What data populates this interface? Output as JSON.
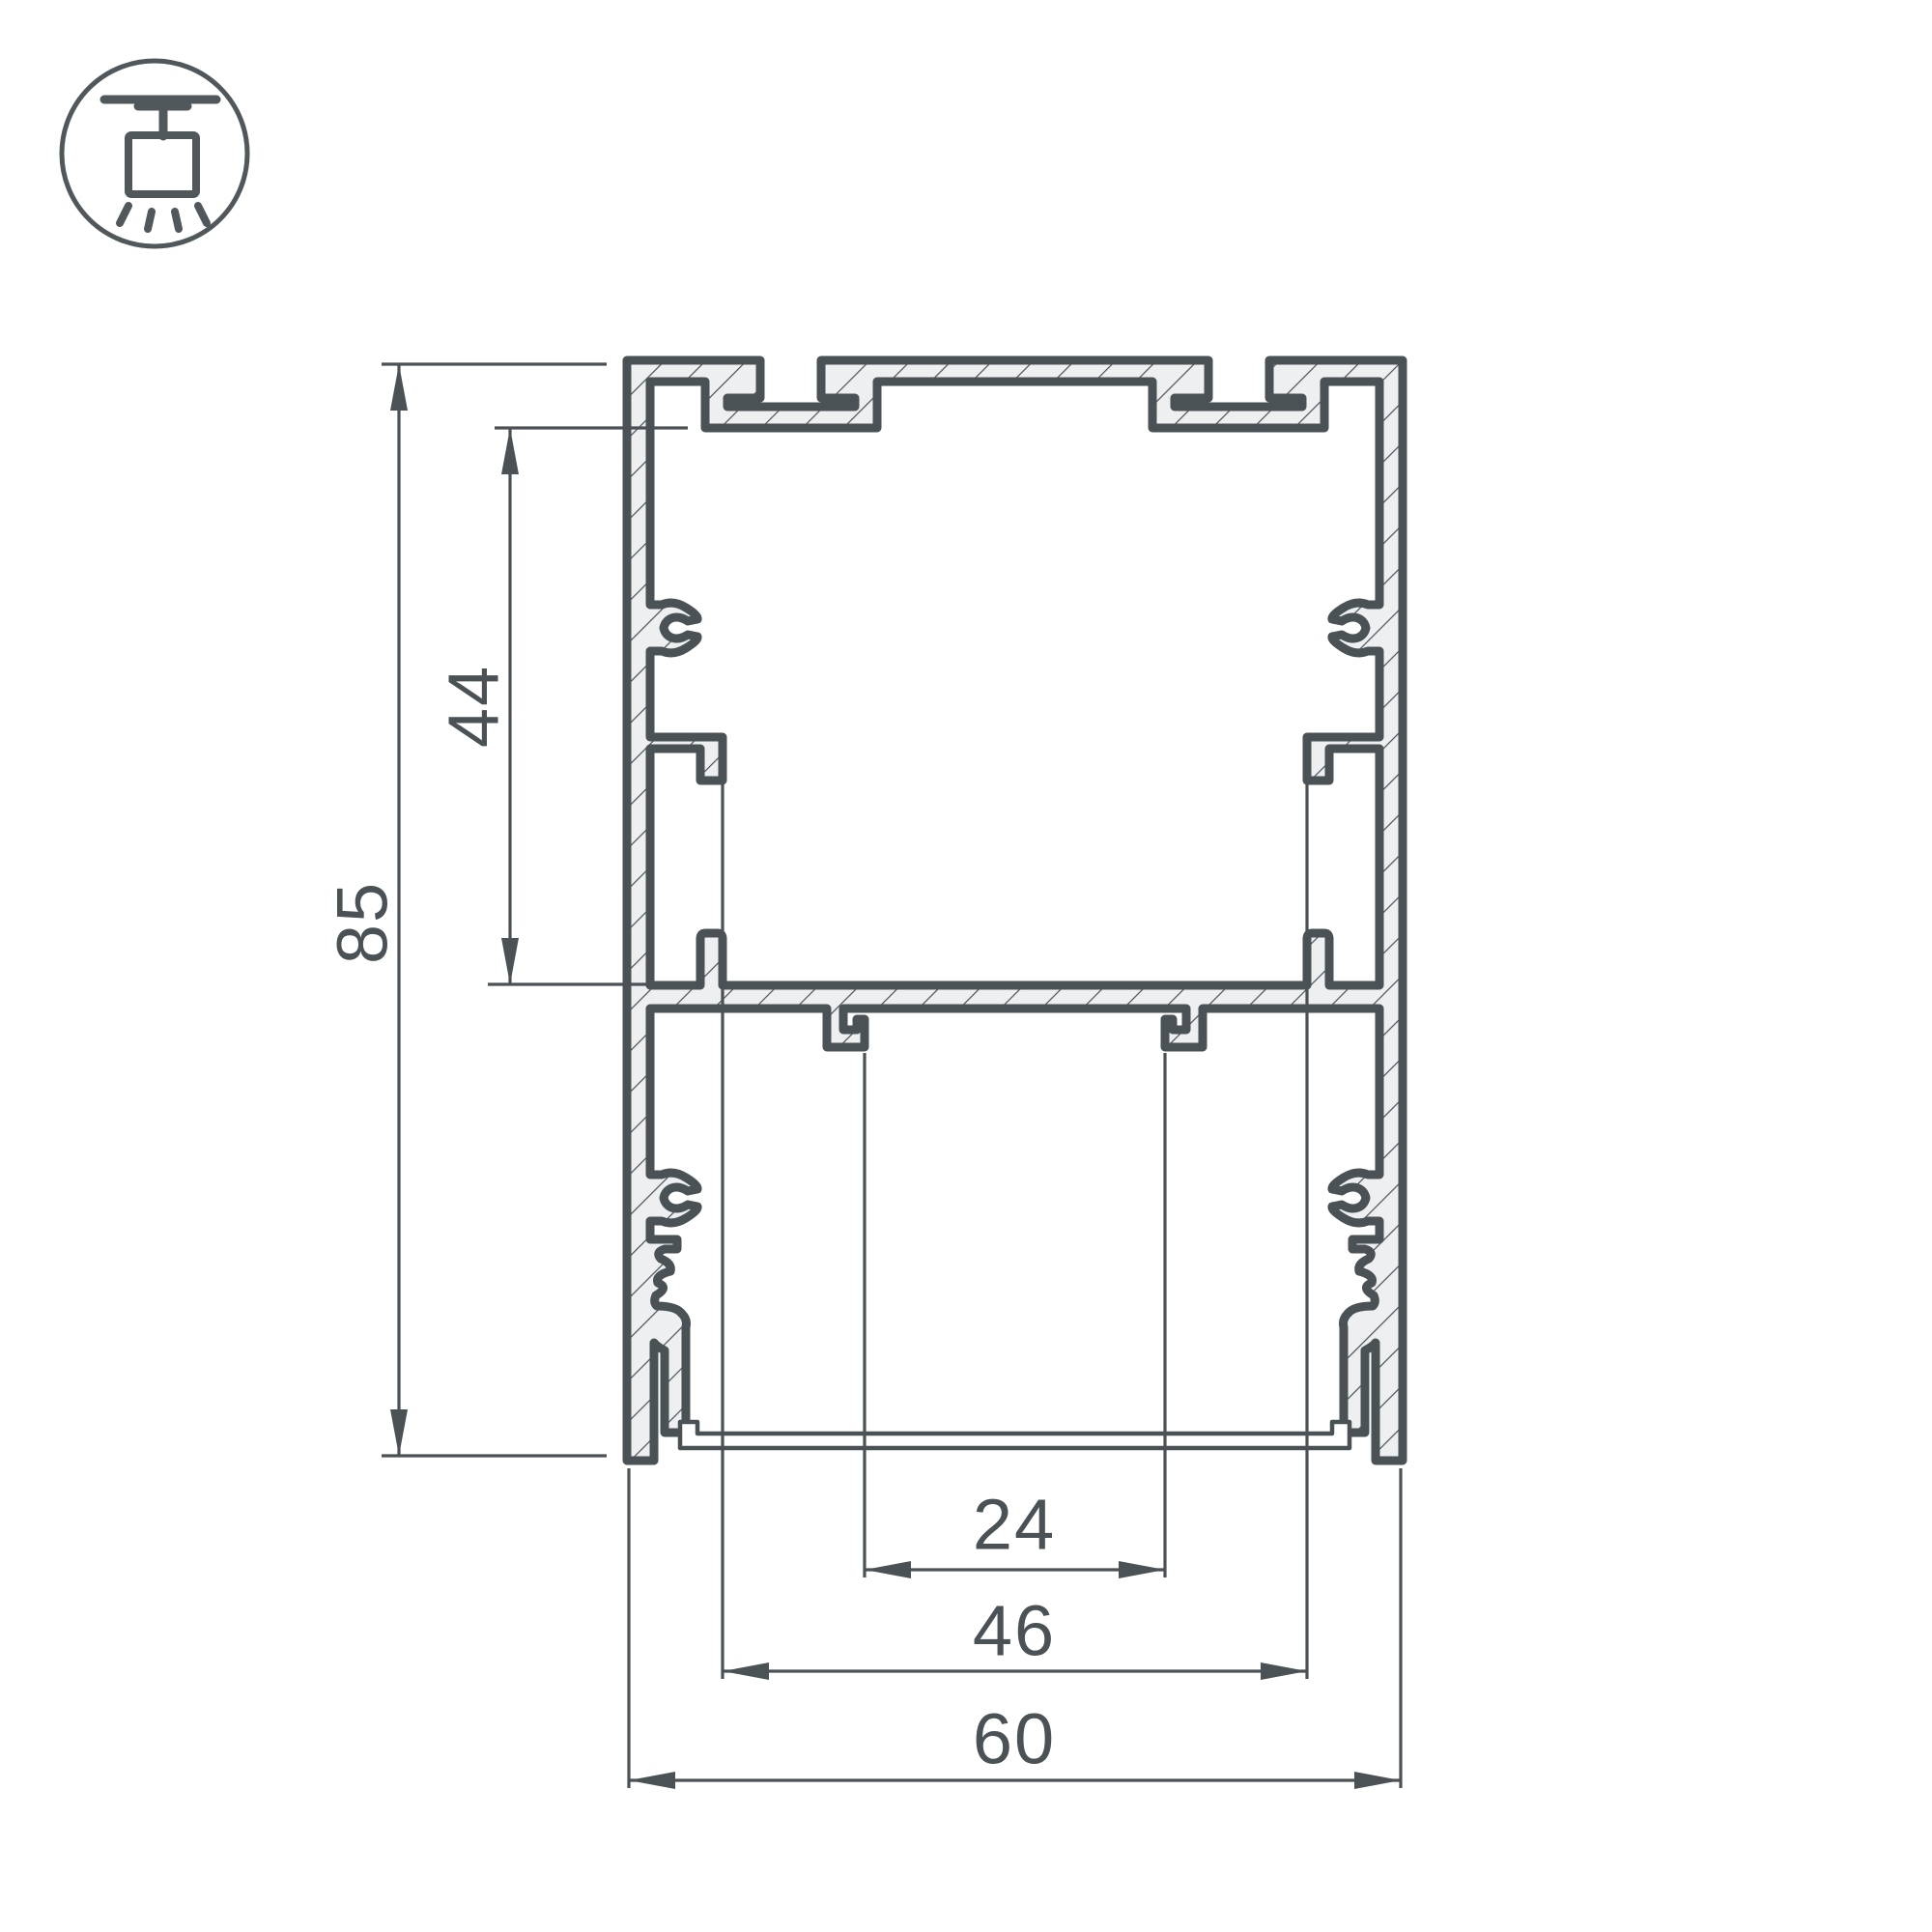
{
  "title": "LED profile cross-section technical drawing",
  "icon": {
    "name": "pendant-mount-icon"
  },
  "dimensions": {
    "overall_height": "85",
    "upper_chamber_height": "44",
    "led_channel_width": "24",
    "inner_width": "46",
    "overall_width": "60"
  },
  "colors": {
    "line": "#4A5256",
    "metal_fill": "#EDEFF0",
    "background": "#FFFFFF"
  }
}
